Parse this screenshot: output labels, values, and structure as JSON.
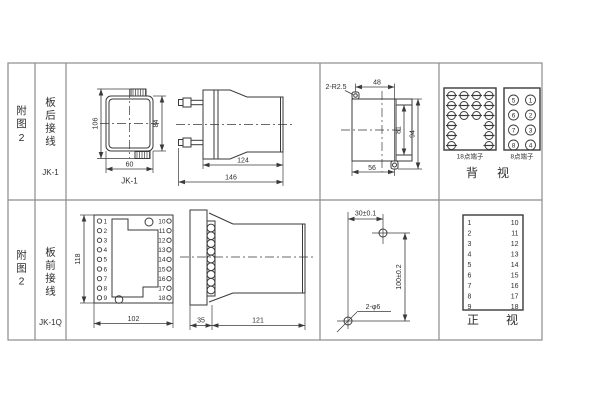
{
  "colors": {
    "background": "#ffffff",
    "line": "#3a3a3a",
    "grid": "#8c8c8c",
    "text": "#2e2e2e"
  },
  "row1": {
    "fig_chars": [
      "附",
      "图",
      "2"
    ],
    "wiring_chars": [
      "板",
      "后",
      "接",
      "线"
    ],
    "model": "JK-1",
    "front_view": {
      "caption": "JK-1",
      "dim_total_height": "106",
      "dim_body_height": "84",
      "dim_width": "60"
    },
    "side_view": {
      "dim_body_depth": "124",
      "dim_total_depth": "146"
    },
    "cutout": {
      "corner_note": "2-R2.5",
      "dim_top_width": "48",
      "dim_inner_height": "81",
      "dim_total_height": "94",
      "dim_bottom_width": "56"
    },
    "back_view": {
      "caption_chars": [
        "背",
        "视"
      ],
      "terminal18_label": "18点端子",
      "terminal8_label": "8点端子",
      "terminal8_left": [
        "5",
        "6",
        "7",
        "8"
      ],
      "terminal8_right": [
        "1",
        "2",
        "3",
        "4"
      ]
    }
  },
  "row2": {
    "fig_chars": [
      "附",
      "图",
      "2"
    ],
    "wiring_chars": [
      "板",
      "前",
      "接",
      "线"
    ],
    "model": "JK-1Q",
    "panel_view": {
      "dim_height": "118",
      "dim_width": "102",
      "left_terminals": [
        "1",
        "2",
        "3",
        "4",
        "5",
        "6",
        "7",
        "8",
        "9"
      ],
      "right_terminals": [
        "10",
        "11",
        "12",
        "13",
        "14",
        "15",
        "16",
        "17",
        "18"
      ]
    },
    "side_view": {
      "dim_plate": "35",
      "dim_body_depth": "121"
    },
    "drill_plan": {
      "dim_horizontal": "30±0.1",
      "dim_vertical": "100±0.2",
      "hole_note": "2-φ6"
    },
    "front_view": {
      "caption_chars": [
        "正",
        "视"
      ],
      "left_column": [
        "1",
        "2",
        "3",
        "4",
        "5",
        "6",
        "7",
        "8",
        "9"
      ],
      "right_column": [
        "10",
        "11",
        "12",
        "13",
        "14",
        "15",
        "16",
        "17",
        "18"
      ]
    }
  }
}
